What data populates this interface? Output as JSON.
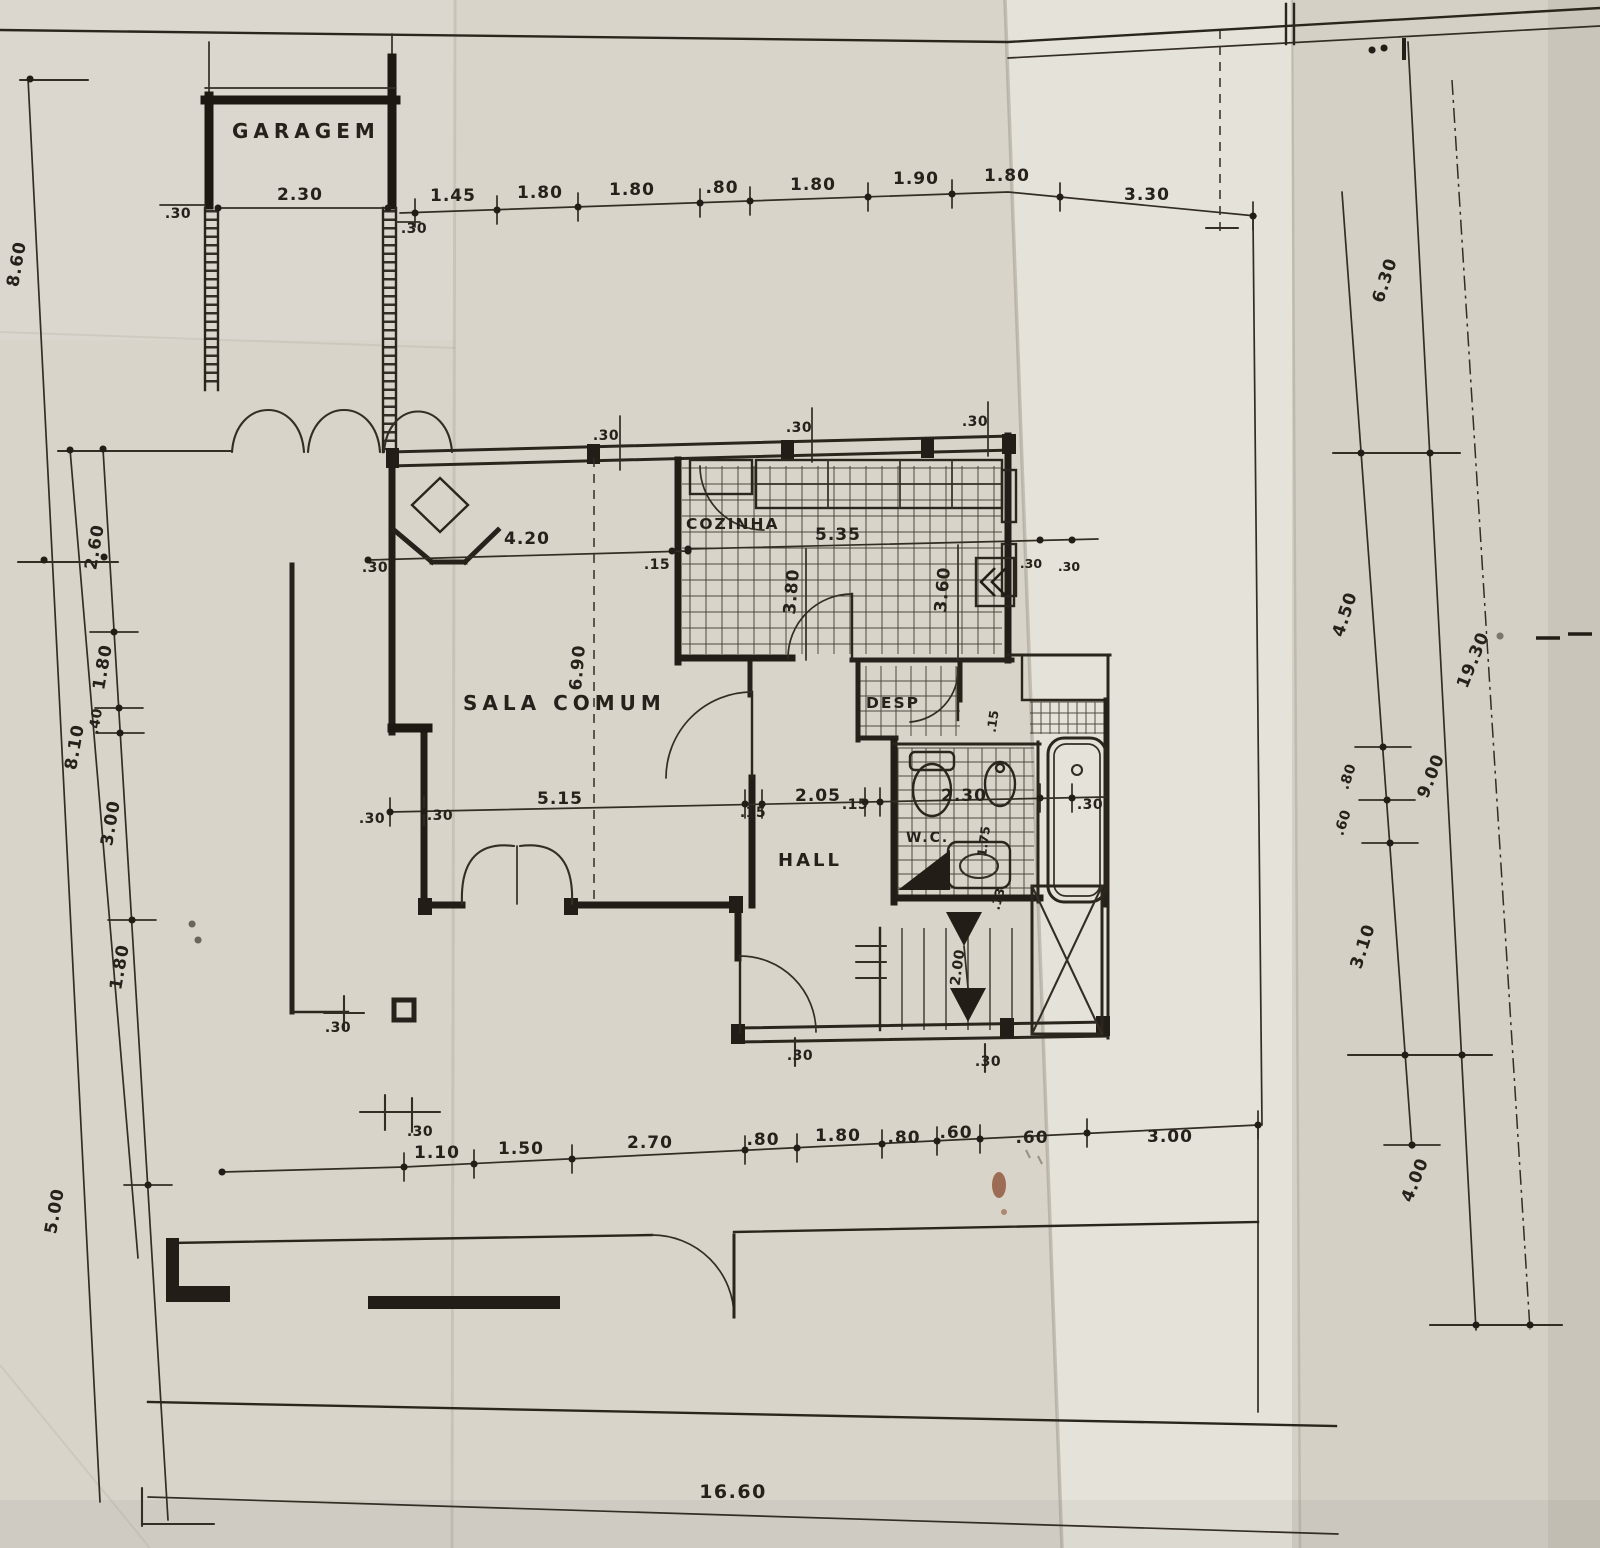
{
  "rooms": {
    "garage": "GARAGEM",
    "living": "SALA COMUM",
    "kitchen": "COZINHA",
    "pantry": "DESP",
    "hall": "HALL",
    "wc": "W.C."
  },
  "dims": {
    "garage_width": "2.30",
    "garage_left_wall": ".30",
    "garage_right_wall": ".30",
    "top": [
      "1.45",
      "1.80",
      "1.80",
      ".80",
      "1.80",
      "1.90",
      "1.80",
      "3.30"
    ],
    "top_wall_ticks": [
      ".30",
      ".30",
      ".30"
    ],
    "left": {
      "outer_top": "8.60",
      "outer_bottom": "5.00",
      "mid": "8.10",
      "inner": [
        "2.60",
        "1.80",
        ".40",
        "3.00",
        "1.80"
      ]
    },
    "sala": {
      "width": "4.20",
      "left_wall": ".30",
      "right_wall": ".15",
      "depth": "6.90"
    },
    "kitchen": {
      "width": "5.35",
      "depth_left": "3.80",
      "depth_right": "3.60",
      "wall_a": ".30",
      "wall_b": ".30"
    },
    "mid": {
      "left_wall": ".30",
      "left_wall2": ".30",
      "sala_span": "5.15",
      "wall_a": ".15",
      "hall_span": "2.05",
      "wall_b": ".15",
      "wc_span": "2.30",
      "tub_wall": ".30"
    },
    "wc_depth": "1.75",
    "desp_wall": ".15",
    "stairs": {
      "width": "2.00",
      "wall": ".13"
    },
    "hall_wall_a": ".30",
    "hall_wall_b": ".30",
    "porch_tick": ".30",
    "entry_tick": ".30",
    "bottom": [
      "1.10",
      "1.50",
      "2.70",
      ".80",
      "1.80",
      ".80",
      ".60",
      ".60",
      "3.00"
    ],
    "right": {
      "upper": "6.30",
      "lot": "9.00",
      "outer": "19.30",
      "seg": [
        "4.50",
        ".80",
        ".60",
        "3.10"
      ],
      "lower": "4.00"
    },
    "site_width": "16.60"
  }
}
